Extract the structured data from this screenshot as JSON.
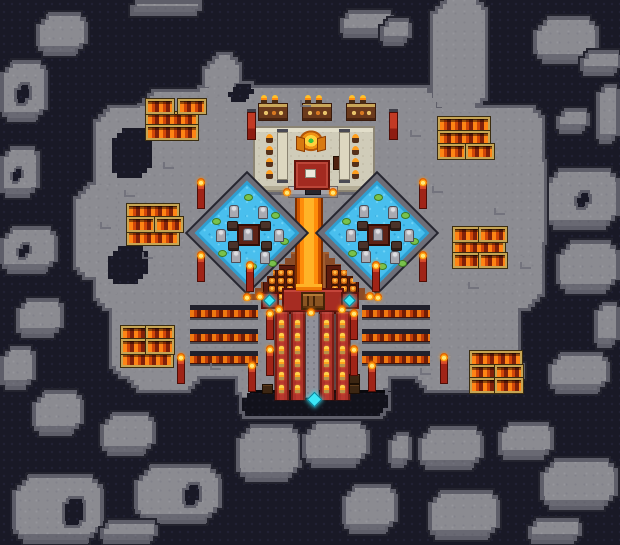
{
  "palette": {
    "void_background": "#191926",
    "rock_fill": "#8c8c92",
    "rock_ring": "#5f5f6a",
    "rock_outline": "#23232e",
    "water_blue": "#49bfee",
    "lava_orange": "#ff8c0a",
    "lava_bright": "#ffb327",
    "carpet_red": "#ad312a",
    "temple_tan": "#d0ccb9",
    "trough_gold_border": "#c7a553",
    "gem_cyan": "#3be6f6",
    "terrace_brown": "#8a4a26"
  },
  "map": {
    "islands": [
      {
        "r": [
          36,
          12,
          52,
          44
        ],
        "c": 12
      },
      {
        "r": [
          0,
          60,
          48,
          62
        ],
        "c": 12,
        "hole": [
          14,
          82,
          18,
          24
        ]
      },
      {
        "r": [
          130,
          0,
          72,
          16
        ],
        "c": 5
      },
      {
        "r": [
          340,
          10,
          54,
          28
        ],
        "c": 8
      },
      {
        "r": [
          380,
          18,
          32,
          28
        ],
        "c": 8
      },
      {
        "r": [
          533,
          16,
          66,
          48
        ],
        "c": 14
      },
      {
        "r": [
          580,
          50,
          42,
          26
        ],
        "c": 8
      },
      {
        "r": [
          596,
          84,
          24,
          60
        ],
        "c": 8
      },
      {
        "r": [
          556,
          108,
          34,
          26
        ],
        "c": 8
      },
      {
        "r": [
          544,
          168,
          76,
          62
        ],
        "c": 14,
        "hole": [
          574,
          190,
          18,
          20
        ]
      },
      {
        "r": [
          556,
          240,
          64,
          54
        ],
        "c": 14
      },
      {
        "r": [
          594,
          302,
          26,
          46
        ],
        "c": 8
      },
      {
        "r": [
          548,
          352,
          62,
          42
        ],
        "c": 12
      },
      {
        "r": [
          0,
          146,
          40,
          52
        ],
        "c": 10,
        "hole": [
          10,
          166,
          14,
          18
        ]
      },
      {
        "r": [
          0,
          226,
          58,
          48
        ],
        "c": 12,
        "hole": [
          16,
          242,
          16,
          18
        ]
      },
      {
        "r": [
          16,
          298,
          48,
          40
        ],
        "c": 10
      },
      {
        "r": [
          0,
          346,
          36,
          44
        ],
        "c": 10
      },
      {
        "r": [
          32,
          390,
          52,
          46
        ],
        "c": 12
      },
      {
        "r": [
          100,
          412,
          56,
          44
        ],
        "c": 12
      },
      {
        "r": [
          12,
          474,
          92,
          70
        ],
        "c": 16,
        "hole": [
          62,
          496,
          24,
          32
        ]
      },
      {
        "r": [
          134,
          464,
          88,
          60
        ],
        "c": 16,
        "hole": [
          182,
          482,
          20,
          26
        ]
      },
      {
        "r": [
          100,
          520,
          58,
          24
        ],
        "c": 8
      },
      {
        "r": [
          236,
          424,
          66,
          58
        ],
        "c": 14
      },
      {
        "r": [
          302,
          420,
          68,
          48
        ],
        "c": 14
      },
      {
        "r": [
          342,
          484,
          56,
          50
        ],
        "c": 12
      },
      {
        "r": [
          388,
          432,
          24,
          36
        ],
        "c": 8
      },
      {
        "r": [
          418,
          426,
          66,
          44
        ],
        "c": 12
      },
      {
        "r": [
          498,
          422,
          56,
          38
        ],
        "c": 10
      },
      {
        "r": [
          540,
          458,
          78,
          52
        ],
        "c": 14
      },
      {
        "r": [
          428,
          490,
          72,
          50
        ],
        "c": 12
      },
      {
        "r": [
          528,
          518,
          54,
          26
        ],
        "c": 8
      }
    ],
    "main": {
      "parts": [
        [
          186,
          88,
          250,
          90
        ],
        [
          205,
          55,
          34,
          42
        ],
        [
          96,
          108,
          216,
          200
        ],
        [
          140,
          92,
          84,
          30
        ],
        [
          312,
          108,
          230,
          200
        ],
        [
          112,
          280,
          406,
          96
        ],
        [
          238,
          330,
          150,
          72
        ],
        [
          433,
          0,
          52,
          112
        ],
        [
          76,
          185,
          42,
          92
        ],
        [
          508,
          152,
          36,
          104
        ],
        [
          130,
          358,
          72,
          32
        ],
        [
          418,
          356,
          104,
          34
        ]
      ],
      "bays": [
        [
          112,
          128,
          40,
          50
        ],
        [
          108,
          246,
          40,
          38
        ],
        [
          228,
          84,
          26,
          18
        ]
      ],
      "water_edge": [
        242,
        390,
        146,
        26
      ]
    },
    "temple": {
      "base": [
        253,
        126,
        118,
        62
      ],
      "idol": [
        296,
        130,
        30,
        24
      ],
      "rug": [
        294,
        160,
        32,
        26
      ],
      "rug_item": [
        305,
        169,
        9,
        7
      ],
      "side_item": [
        333,
        156,
        8,
        12
      ],
      "scrolls": [
        [
          277,
          132
        ],
        [
          339,
          132
        ]
      ],
      "scroll_size": [
        9,
        46
      ],
      "candle_cols": [
        266,
        352
      ],
      "candle_rows": [
        134,
        146,
        158,
        170
      ],
      "steps": [
        288,
        186,
        48,
        10
      ],
      "door": [
        305,
        183,
        14,
        10
      ],
      "altars": [
        [
          258,
          103
        ],
        [
          302,
          103
        ],
        [
          346,
          103
        ]
      ],
      "altar_size": [
        28,
        16
      ],
      "torches": [
        [
          261,
          95
        ],
        [
          272,
          95
        ],
        [
          305,
          95
        ],
        [
          316,
          95
        ],
        [
          349,
          95
        ],
        [
          360,
          95
        ]
      ],
      "banners": [
        [
          247,
          112
        ],
        [
          389,
          112
        ]
      ]
    },
    "ponds": {
      "list": [
        [
          247,
          233
        ],
        [
          377,
          233
        ]
      ],
      "size": 84,
      "platform": [
        19,
        18
      ],
      "statues": [
        [
          -18,
          -28
        ],
        [
          11,
          -27
        ],
        [
          -31,
          -4
        ],
        [
          27,
          -4
        ],
        [
          -16,
          17
        ],
        [
          13,
          18
        ]
      ],
      "monsters": [
        [
          -20,
          -12
        ],
        [
          13,
          -12
        ],
        [
          -19,
          8
        ],
        [
          14,
          8
        ]
      ],
      "pads": [
        [
          -3,
          -39
        ],
        [
          24,
          -21
        ],
        [
          -35,
          -15
        ],
        [
          33,
          5
        ],
        [
          -29,
          17
        ],
        [
          1,
          30
        ],
        [
          21,
          27
        ]
      ]
    },
    "river": {
      "lip": [
        289,
        186,
        40,
        8
      ],
      "flow": [
        295,
        190,
        28,
        102
      ],
      "mouth": [
        296,
        284,
        26,
        7
      ]
    },
    "terraces": [
      {
        "x": 243,
        "y": 252,
        "w": 54,
        "h": 48,
        "side": "left",
        "floor": [
          20,
          13,
          31,
          33
        ]
      },
      {
        "x": 323,
        "y": 252,
        "w": 54,
        "h": 48,
        "side": "right",
        "floor": [
          3,
          13,
          31,
          33
        ]
      }
    ],
    "pot_grid": {
      "cols": 3,
      "rows": 4,
      "dx": 9,
      "dy": 8,
      "size": [
        6,
        6
      ],
      "origin": [
        4,
        3
      ]
    },
    "ceremony": {
      "platform": [
        282,
        288,
        58,
        22
      ],
      "chest": [
        301,
        292,
        20,
        14
      ],
      "gem_pads": [
        [
          261,
          292,
          14,
          13
        ],
        [
          341,
          292,
          14,
          13
        ]
      ],
      "path": [
        305,
        312,
        14,
        86
      ],
      "carpets": [
        [
          275,
          312
        ],
        [
          291,
          312
        ],
        [
          320,
          312
        ],
        [
          336,
          312
        ]
      ],
      "carpet_size": [
        14,
        88
      ],
      "candles_per_carpet": 6,
      "path_gem": [
        309,
        394,
        9,
        9
      ],
      "crates": [
        [
          349,
          374
        ],
        [
          349,
          384
        ],
        [
          262,
          384
        ]
      ]
    },
    "trenches": {
      "size": [
        68,
        13
      ],
      "list": [
        [
          190,
          305
        ],
        [
          190,
          329
        ],
        [
          190,
          351
        ],
        [
          362,
          305
        ],
        [
          362,
          329
        ],
        [
          362,
          351
        ]
      ]
    },
    "troughs": {
      "wide_size": [
        48,
        11
      ],
      "small_size": [
        24,
        11
      ],
      "wide": [
        [
          146,
          112
        ],
        [
          146,
          125
        ],
        [
          438,
          117
        ],
        [
          438,
          131
        ],
        [
          127,
          204
        ],
        [
          127,
          230
        ],
        [
          453,
          240
        ],
        [
          121,
          352
        ],
        [
          470,
          351
        ]
      ],
      "small": [
        [
          146,
          99
        ],
        [
          178,
          99
        ],
        [
          438,
          144
        ],
        [
          466,
          144
        ],
        [
          127,
          217
        ],
        [
          155,
          217
        ],
        [
          453,
          227
        ],
        [
          479,
          227
        ],
        [
          453,
          253
        ],
        [
          479,
          253
        ],
        [
          121,
          326
        ],
        [
          146,
          326
        ],
        [
          121,
          339
        ],
        [
          146,
          339
        ],
        [
          470,
          365
        ],
        [
          495,
          365
        ],
        [
          470,
          378
        ],
        [
          495,
          378
        ]
      ]
    },
    "pillars": [
      [
        266,
        314
      ],
      [
        266,
        350
      ],
      [
        248,
        366
      ],
      [
        350,
        314
      ],
      [
        350,
        350
      ],
      [
        368,
        366
      ],
      [
        197,
        183
      ],
      [
        197,
        256
      ],
      [
        419,
        183
      ],
      [
        419,
        256
      ],
      [
        177,
        358
      ],
      [
        440,
        358
      ],
      [
        246,
        266
      ],
      [
        372,
        266
      ]
    ],
    "flames": [
      [
        283,
        188
      ],
      [
        329,
        188
      ],
      [
        275,
        305
      ],
      [
        307,
        308
      ],
      [
        338,
        305
      ],
      [
        256,
        292
      ],
      [
        366,
        292
      ],
      [
        243,
        293
      ],
      [
        374,
        293
      ]
    ],
    "cracks": [
      [
        163,
        162
      ],
      [
        124,
        190
      ],
      [
        432,
        186
      ],
      [
        494,
        208
      ],
      [
        142,
        252
      ],
      [
        468,
        282
      ],
      [
        210,
        363
      ],
      [
        420,
        368
      ],
      [
        100,
        222
      ],
      [
        520,
        262
      ],
      [
        300,
        100
      ],
      [
        410,
        130
      ]
    ]
  }
}
